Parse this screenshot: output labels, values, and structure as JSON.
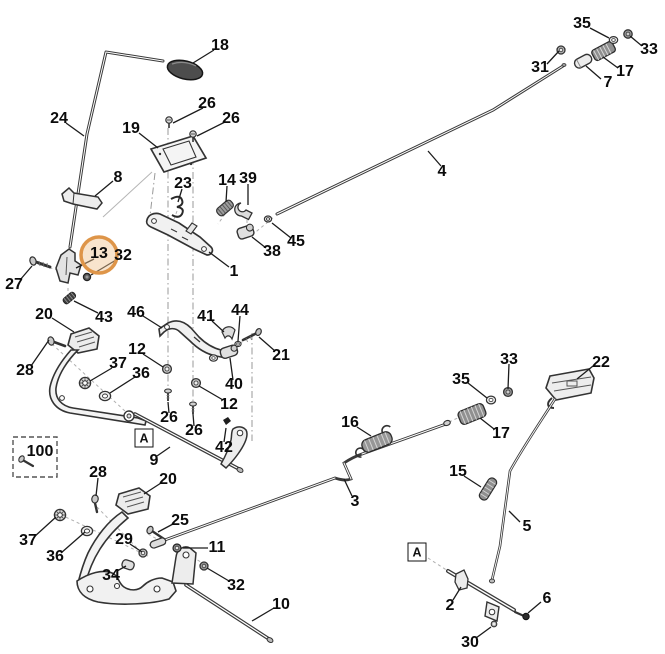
{
  "diagram": {
    "type": "exploded-parts-diagram",
    "highlighted_part": "13",
    "colors": {
      "background": "#ffffff",
      "line": "#3a3a3a",
      "label": "#0b0b0b",
      "highlight_ring": "#de9549",
      "highlight_fill": "rgba(240,196,145,0.45)"
    },
    "labels": [
      {
        "text": "18",
        "x": 220,
        "y": 46
      },
      {
        "text": "24",
        "x": 59,
        "y": 119
      },
      {
        "text": "26",
        "x": 207,
        "y": 104
      },
      {
        "text": "26",
        "x": 231,
        "y": 119
      },
      {
        "text": "19",
        "x": 131,
        "y": 129
      },
      {
        "text": "8",
        "x": 118,
        "y": 178
      },
      {
        "text": "23",
        "x": 183,
        "y": 184
      },
      {
        "text": "14",
        "x": 227,
        "y": 181
      },
      {
        "text": "39",
        "x": 248,
        "y": 179
      },
      {
        "text": "35",
        "x": 582,
        "y": 24
      },
      {
        "text": "33",
        "x": 649,
        "y": 50
      },
      {
        "text": "31",
        "x": 540,
        "y": 68
      },
      {
        "text": "17",
        "x": 625,
        "y": 72
      },
      {
        "text": "7",
        "x": 608,
        "y": 83
      },
      {
        "text": "4",
        "x": 442,
        "y": 172
      },
      {
        "text": "13",
        "x": 99,
        "y": 254,
        "highlighted": true
      },
      {
        "text": "32",
        "x": 123,
        "y": 256
      },
      {
        "text": "27",
        "x": 14,
        "y": 285
      },
      {
        "text": "1",
        "x": 234,
        "y": 272
      },
      {
        "text": "38",
        "x": 272,
        "y": 252
      },
      {
        "text": "45",
        "x": 296,
        "y": 242
      },
      {
        "text": "43",
        "x": 104,
        "y": 318
      },
      {
        "text": "20",
        "x": 44,
        "y": 315
      },
      {
        "text": "46",
        "x": 136,
        "y": 313
      },
      {
        "text": "41",
        "x": 206,
        "y": 317
      },
      {
        "text": "44",
        "x": 240,
        "y": 311
      },
      {
        "text": "21",
        "x": 281,
        "y": 356
      },
      {
        "text": "28",
        "x": 25,
        "y": 371
      },
      {
        "text": "12",
        "x": 137,
        "y": 350
      },
      {
        "text": "37",
        "x": 118,
        "y": 364
      },
      {
        "text": "36",
        "x": 141,
        "y": 374
      },
      {
        "text": "40",
        "x": 234,
        "y": 385
      },
      {
        "text": "12",
        "x": 229,
        "y": 405
      },
      {
        "text": "26",
        "x": 169,
        "y": 418
      },
      {
        "text": "26",
        "x": 194,
        "y": 431
      },
      {
        "text": "42",
        "x": 224,
        "y": 448
      },
      {
        "text": "9",
        "x": 154,
        "y": 461
      },
      {
        "text": "100",
        "x": 40,
        "y": 452
      },
      {
        "text": "28",
        "x": 98,
        "y": 473
      },
      {
        "text": "20",
        "x": 168,
        "y": 480
      },
      {
        "text": "25",
        "x": 180,
        "y": 521
      },
      {
        "text": "29",
        "x": 124,
        "y": 540
      },
      {
        "text": "11",
        "x": 217,
        "y": 548
      },
      {
        "text": "37",
        "x": 28,
        "y": 541
      },
      {
        "text": "36",
        "x": 55,
        "y": 557
      },
      {
        "text": "34",
        "x": 111,
        "y": 576
      },
      {
        "text": "32",
        "x": 236,
        "y": 586
      },
      {
        "text": "10",
        "x": 281,
        "y": 605
      },
      {
        "text": "16",
        "x": 350,
        "y": 423
      },
      {
        "text": "3",
        "x": 355,
        "y": 502
      },
      {
        "text": "33",
        "x": 509,
        "y": 360
      },
      {
        "text": "35",
        "x": 461,
        "y": 380
      },
      {
        "text": "17",
        "x": 501,
        "y": 434
      },
      {
        "text": "22",
        "x": 601,
        "y": 363
      },
      {
        "text": "15",
        "x": 458,
        "y": 472
      },
      {
        "text": "5",
        "x": 527,
        "y": 527
      },
      {
        "text": "2",
        "x": 450,
        "y": 606
      },
      {
        "text": "6",
        "x": 547,
        "y": 599
      },
      {
        "text": "30",
        "x": 470,
        "y": 643
      }
    ],
    "ref_markers": [
      {
        "text": "A",
        "x": 144,
        "y": 438
      },
      {
        "text": "A",
        "x": 417,
        "y": 552
      }
    ]
  }
}
